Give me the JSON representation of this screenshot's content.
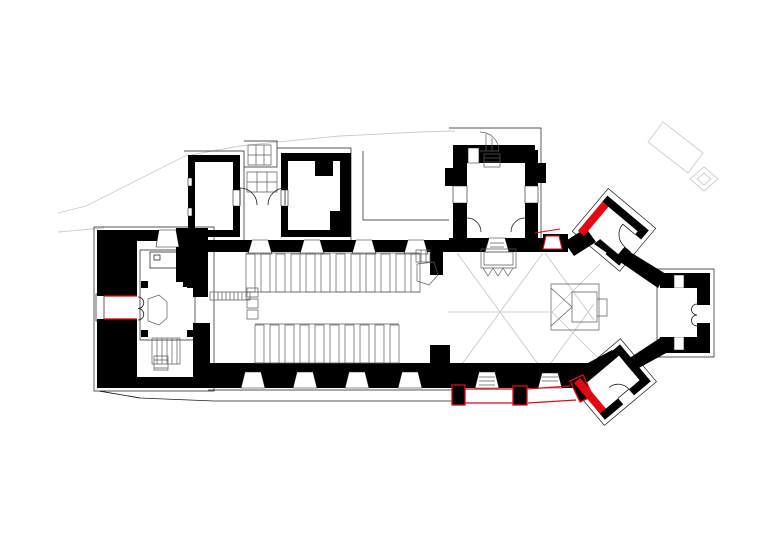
{
  "document": {
    "title": "church-floor-plan-survey-drawing",
    "paper_color": "#ffffff"
  },
  "colors": {
    "wall": "#000000",
    "line": "#1c1c1c",
    "furniture": "#5b5b5b",
    "vault": "#c4c4c4",
    "site": "#cccccc",
    "red": "#e30613",
    "white": "#ffffff"
  },
  "plan": {
    "spaces": [
      "west-tower",
      "nave",
      "north-room-a",
      "north-room-b",
      "north-stair-passage",
      "north-transept",
      "chancel",
      "apse",
      "north-east-chapel",
      "east-chapel",
      "south-east-chapel"
    ],
    "furniture_items": [
      "pews",
      "pulpit",
      "altar",
      "organ",
      "font",
      "tower-stairs",
      "transept-spiral-stair",
      "entrance-steps"
    ],
    "red_elements": [
      "west-door-reveals",
      "north-east-chapel-wall",
      "chancel-north-corner-gap",
      "south-chancel-buttresses",
      "south-chancel-wall-line",
      "south-east-chapel-wall"
    ],
    "site_features": [
      "boundary-contour-upper",
      "boundary-contour-lower",
      "churchyard-monument-rect",
      "churchyard-monument-square"
    ],
    "pews": {
      "north": {
        "count": 12,
        "x0": 246,
        "y": 254,
        "w": 9,
        "h": 38,
        "step": 15
      },
      "south": {
        "count": 10,
        "x0": 255,
        "y": 325,
        "w": 9,
        "h": 38,
        "step": 15
      }
    }
  }
}
